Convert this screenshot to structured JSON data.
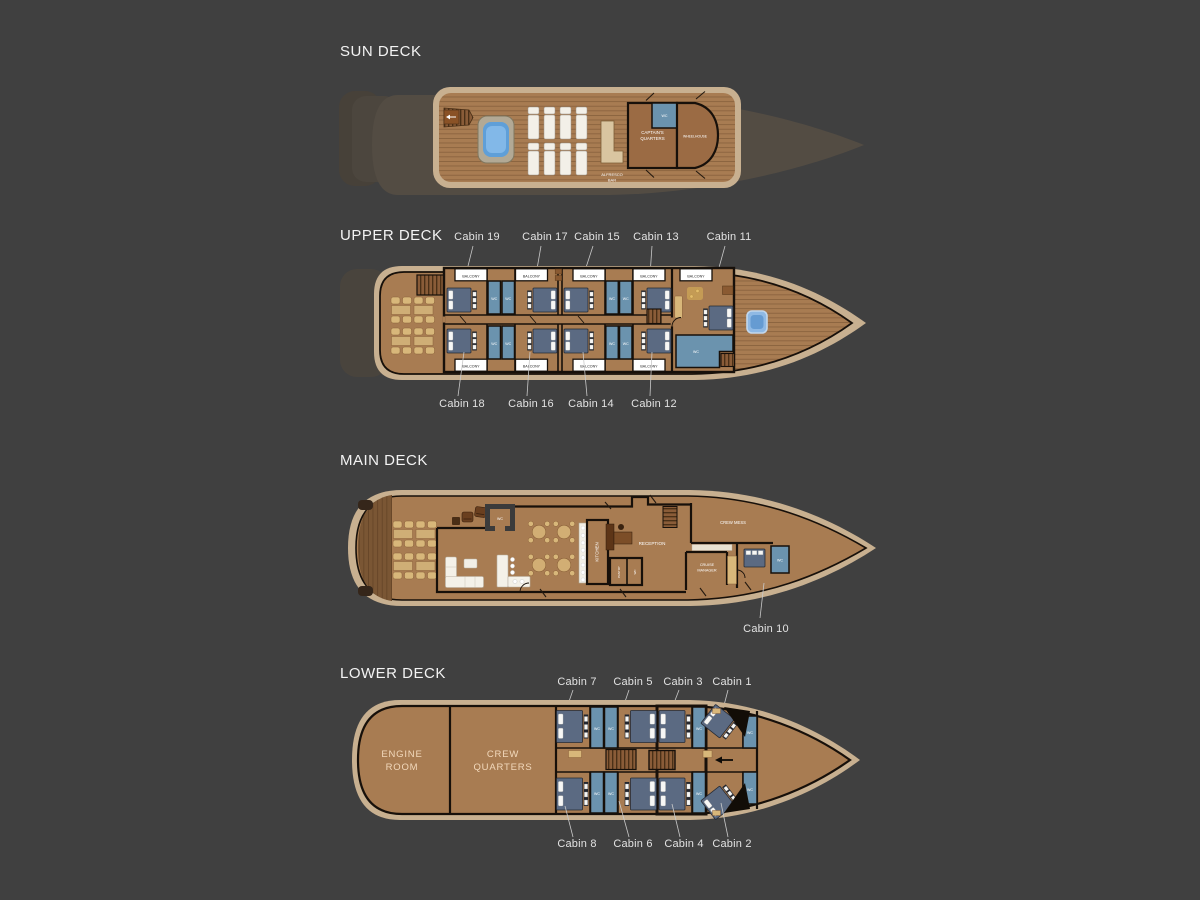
{
  "page": {
    "background": "#404040",
    "type": "yacht-deck-plan"
  },
  "labels": {
    "balcony": "BALCONY",
    "wc": "WC"
  },
  "colors": {
    "background": "#404040",
    "hull_beige": "#c8b090",
    "wood_floor": "#a87c52",
    "dark_wood": "#7a5634",
    "wall": "#17100a",
    "wc_blue": "#6b93ae",
    "bed_blue": "#5b6a82",
    "water_blue": "#5f9fd8",
    "furniture_tan": "#d8b77a",
    "callout_text": "#e2e2e2",
    "room_label_text": "#f2d9bc"
  },
  "decks": {
    "sun": {
      "title": "SUN DECK",
      "rooms": {
        "captains_line1": "CAPTAIN'S",
        "captains_line2": "QUARTERS",
        "wheelhouse": "WHEELHOUSE",
        "alfresco_line1": "ALFRESCO",
        "alfresco_line2": "BAR"
      }
    },
    "upper": {
      "title": "UPPER DECK",
      "callouts_top": [
        "Cabin 19",
        "Cabin 17",
        "Cabin 15",
        "Cabin 13",
        "Cabin 11"
      ],
      "callouts_bottom": [
        "Cabin 18",
        "Cabin 16",
        "Cabin 14",
        "Cabin 12"
      ]
    },
    "main": {
      "title": "MAIN DECK",
      "rooms": {
        "kitchen": "KITCHEN",
        "reception": "RECEPTION",
        "crew_mess": "CREW MESS",
        "cruise_line1": "CRUISE",
        "cruise_line2": "MANAGER",
        "pantry": "PANTRY"
      },
      "callout": "Cabin 10"
    },
    "lower": {
      "title": "LOWER DECK",
      "rooms": {
        "engine_line1": "ENGINE",
        "engine_line2": "ROOM",
        "crew_line1": "CREW",
        "crew_line2": "QUARTERS"
      },
      "callouts_top": [
        "Cabin 7",
        "Cabin 5",
        "Cabin 3",
        "Cabin 1"
      ],
      "callouts_bottom": [
        "Cabin 8",
        "Cabin 6",
        "Cabin 4",
        "Cabin 2"
      ]
    }
  }
}
